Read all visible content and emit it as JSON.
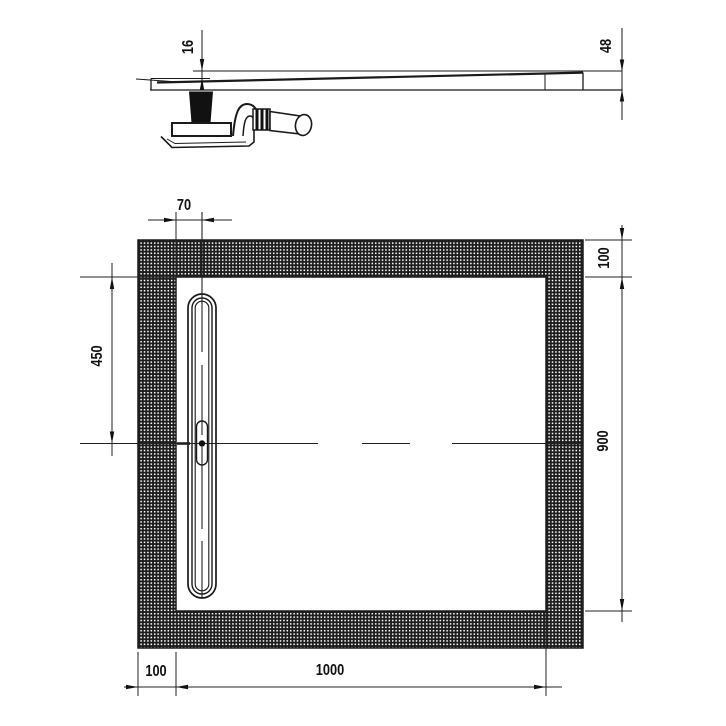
{
  "drawing": {
    "kind": "technical-drawing",
    "colors": {
      "line": "#1a1a1a",
      "hatch": "#1c1c1c",
      "background": "#ffffff"
    },
    "dims": {
      "side_drop": "16",
      "side_height": "48",
      "drain_offset": "70",
      "border_top": "100",
      "drain_center_from_top": "450",
      "inner_length": "900",
      "border_left": "100",
      "inner_width": "1000"
    }
  }
}
